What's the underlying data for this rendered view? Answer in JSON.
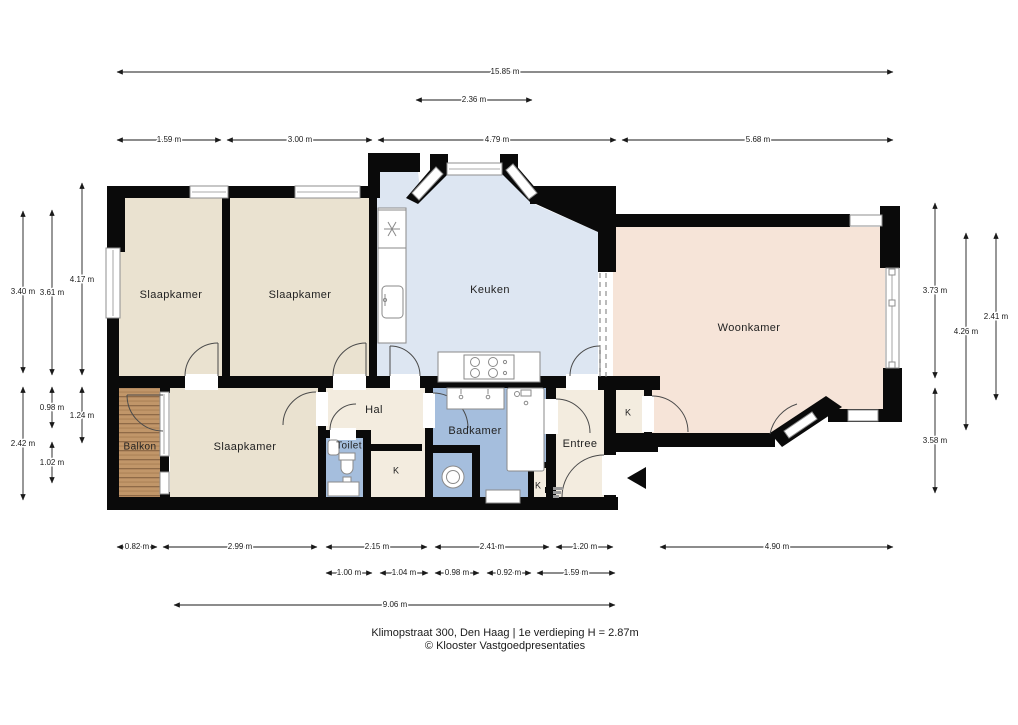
{
  "caption": {
    "line1": "Klimopstraat 300, Den Haag | 1e verdieping H = 2.87m",
    "line2": "© Klooster Vastgoedpresentaties"
  },
  "rooms": {
    "slaapkamer_1": "Slaapkamer",
    "slaapkamer_2": "Slaapkamer",
    "slaapkamer_3": "Slaapkamer",
    "keuken": "Keuken",
    "woonkamer": "Woonkamer",
    "hal": "Hal",
    "toilet": "Toilet",
    "badkamer": "Badkamer",
    "entree": "Entree",
    "balkon": "Balkon",
    "kast_hal": "K",
    "kast_entree": "K",
    "kast_woonkamer": "K"
  },
  "dimensions": {
    "top": [
      "15.85 m",
      "2.36 m",
      "1.59 m",
      "3.00 m",
      "4.79 m",
      "5.68 m"
    ],
    "left": [
      "3.40 m",
      "2.42 m",
      "3.61 m",
      "0.98 m",
      "1.02 m",
      "4.17 m",
      "1.24 m"
    ],
    "right": [
      "3.73 m",
      "2.41 m",
      "4.26 m",
      "3.58 m"
    ],
    "bottom": [
      "0.82 m",
      "2.99 m",
      "2.15 m",
      "2.41 m",
      "1.20 m",
      "4.90 m",
      "1.00 m",
      "1.04 m",
      "0.98 m",
      "0.92 m",
      "1.59 m",
      "9.06 m"
    ]
  },
  "colors": {
    "wall": "#0a0a0a",
    "bedroom_floor": "#eae2d0",
    "kitchen_floor": "#dde6f2",
    "bath_floor": "#a5bedd",
    "living_floor": "#f6e4d8",
    "hall_floor": "#f3ecdf",
    "balcony_wood": "#c19669",
    "window_frame": "#8f8f8f",
    "dimension_text": "#1a1a1a"
  }
}
